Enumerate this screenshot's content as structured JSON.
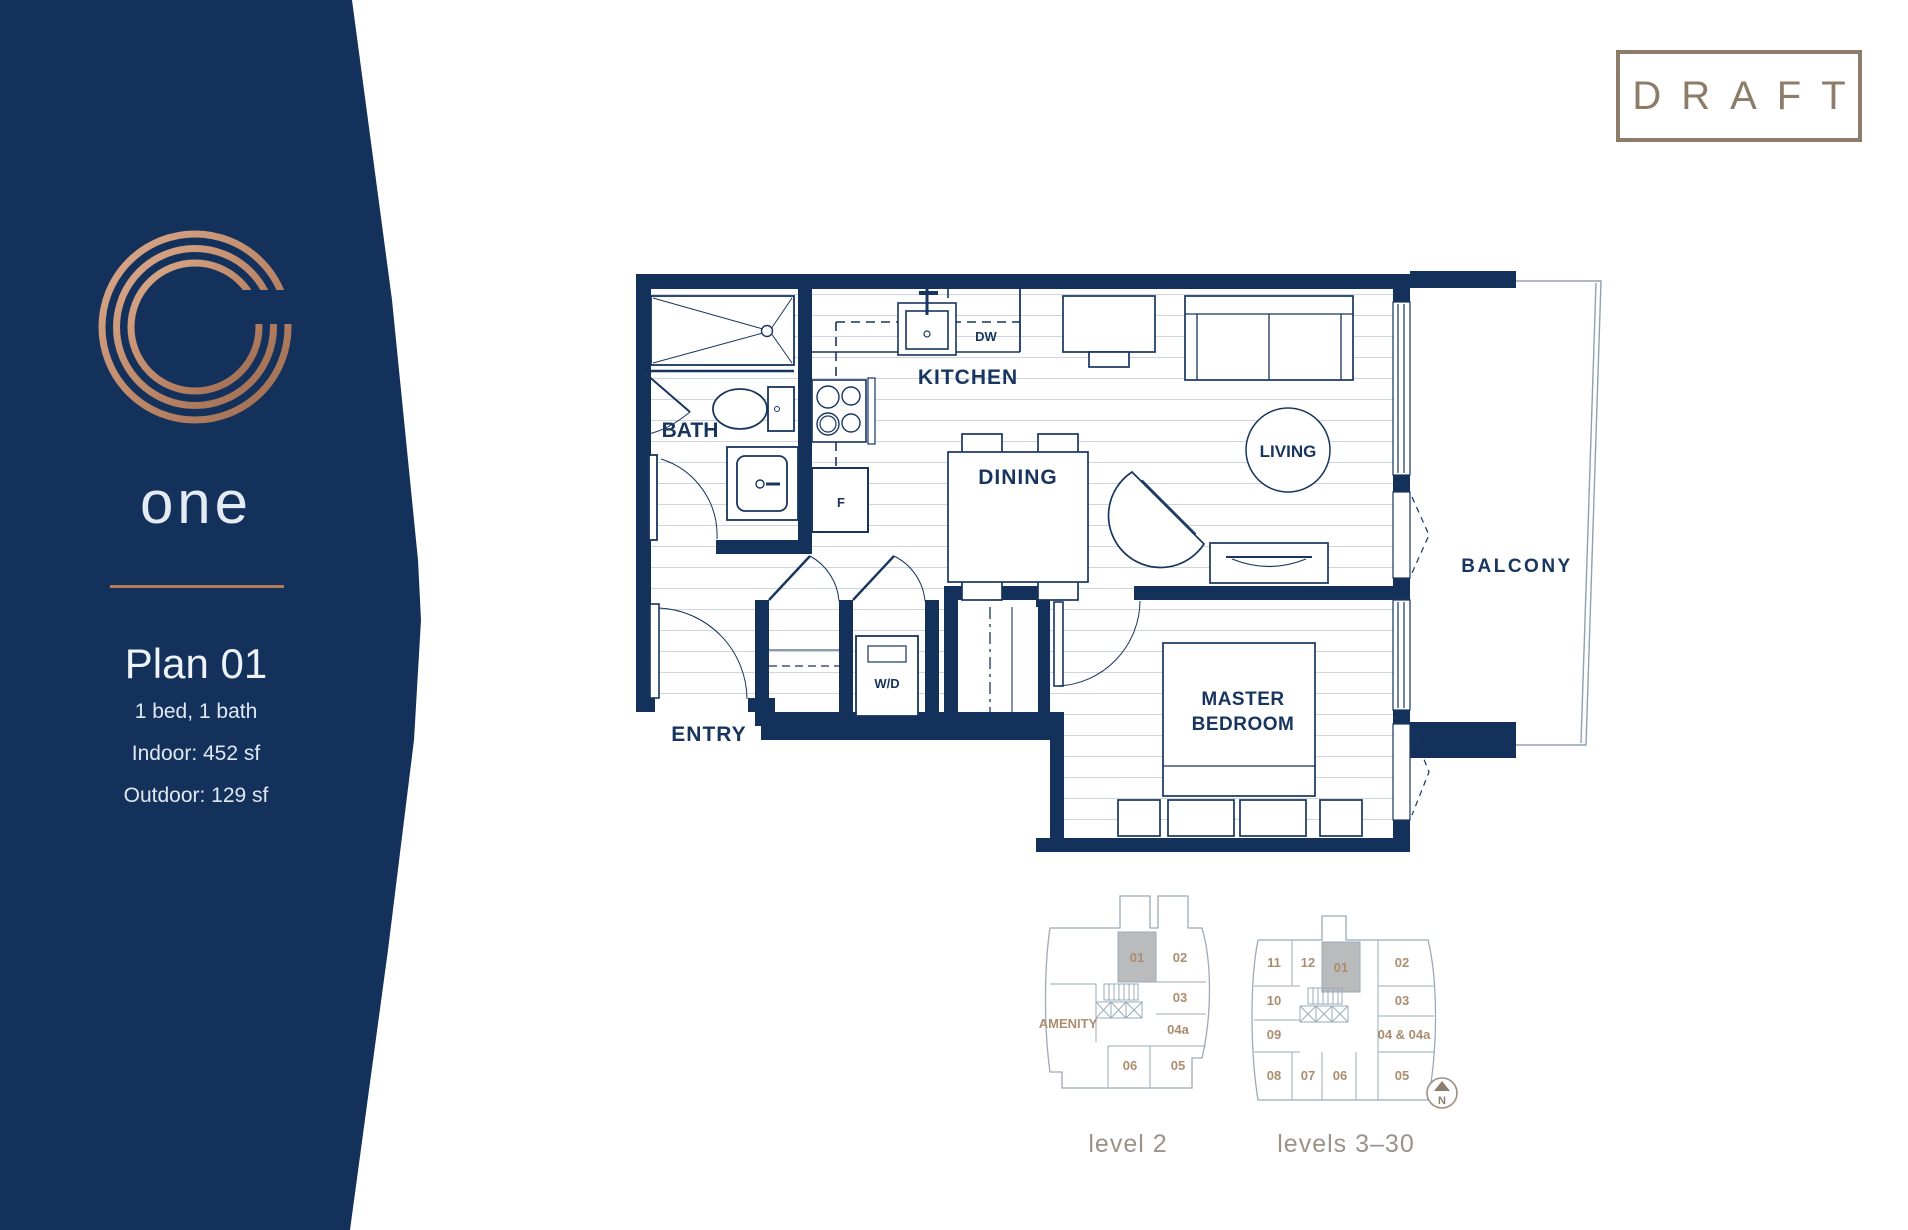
{
  "sidebar": {
    "logo_letter": "G",
    "brand": "one",
    "plan_title": "Plan 01",
    "plan_specs": [
      "1 bed, 1 bath",
      "Indoor: 452 sf",
      "Outdoor: 129 sf"
    ]
  },
  "stamp": {
    "label": "DRAFT"
  },
  "floorplan": {
    "rooms": {
      "bath": "BATH",
      "kitchen": "KITCHEN",
      "dining": "DINING",
      "living": "LIVING",
      "entry": "ENTRY",
      "master_line1": "MASTER",
      "master_line2": "BEDROOM",
      "balcony": "BALCONY"
    },
    "appliances": {
      "washer_dryer": "W/D",
      "dishwasher": "DW",
      "fridge": "F"
    }
  },
  "keyplans": {
    "level2": {
      "caption": "level 2",
      "amenity_label": "AMENITY",
      "highlighted_unit": "01",
      "units": [
        "01",
        "02",
        "03",
        "04a",
        "05",
        "06"
      ]
    },
    "levels3_30": {
      "caption": "levels 3–30",
      "highlighted_unit": "01",
      "units": [
        "11",
        "12",
        "01",
        "02",
        "10",
        "03",
        "09",
        "04 & 04a",
        "08",
        "07",
        "06",
        "05"
      ]
    },
    "north_label": "N"
  },
  "colors": {
    "navy": "#14315c",
    "copper": "#b17c5c",
    "draft": "#8d7c69",
    "keyplan_text": "#ab8d70"
  }
}
